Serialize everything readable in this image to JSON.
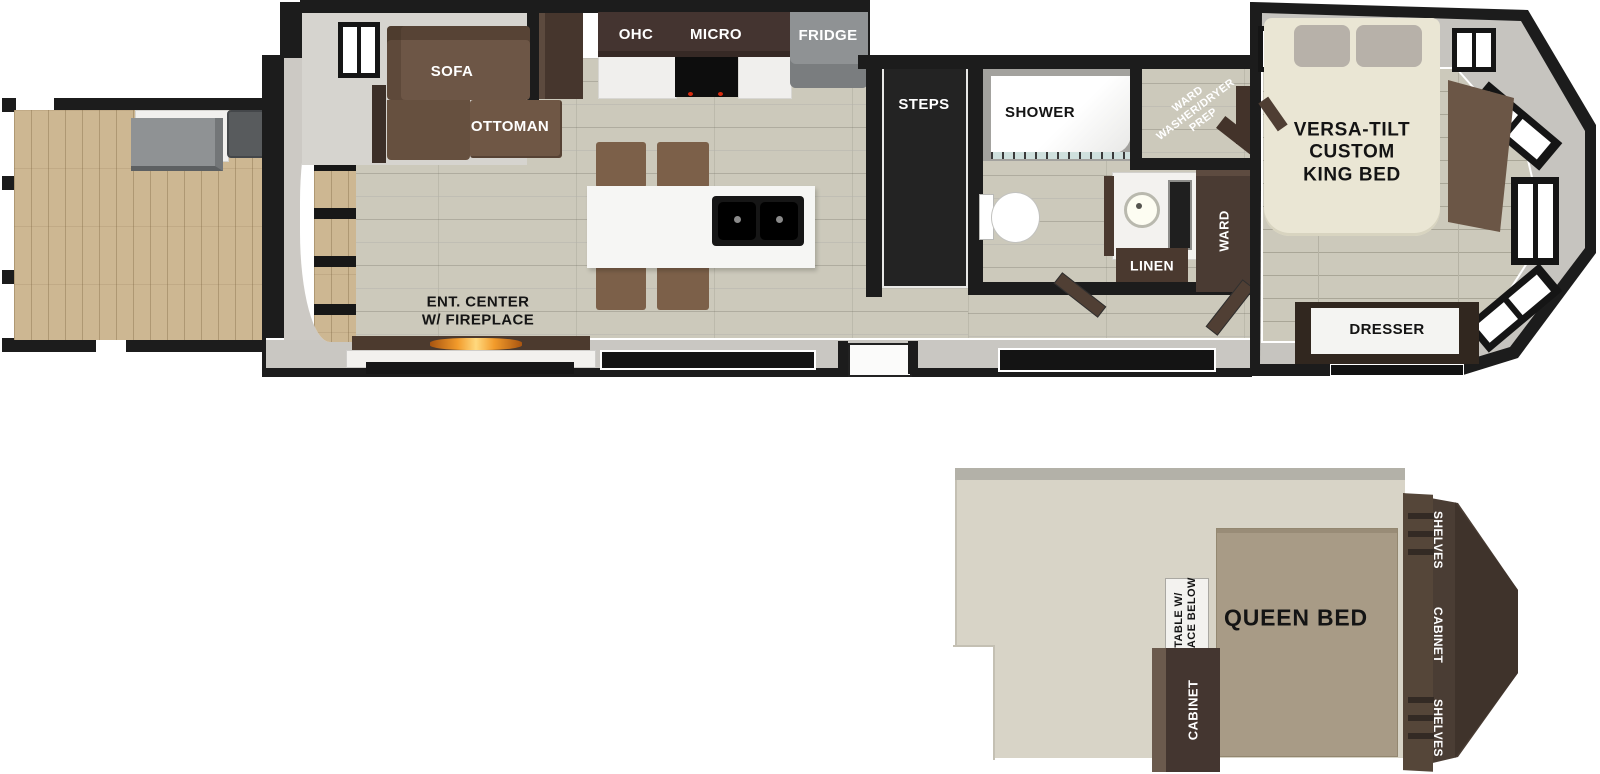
{
  "main_floor": {
    "living": {
      "sofa_label": "SOFA",
      "ottoman_label": "OTTOMAN",
      "ent_center_label": "ENT. CENTER\nW/ FIREPLACE"
    },
    "kitchen": {
      "ohc_label": "OHC",
      "micro_label": "MICRO",
      "fridge_label": "FRIDGE"
    },
    "steps_label": "STEPS",
    "bathroom": {
      "shower_label": "SHOWER",
      "linen_label": "LINEN"
    },
    "storage": {
      "ward_wd_prep_label": "WARD\nWASHER/DRYER\nPREP",
      "ward_label": "WARD"
    },
    "bedroom": {
      "king_bed_label": "VERSA-TILT\nCUSTOM\nKING BED",
      "dresser_label": "DRESSER"
    }
  },
  "loft": {
    "queen_bed_label": "QUEEN BED",
    "table_label": "TABLE W/\nSPACE BELOW",
    "cabinet_label": "CABINET",
    "right_unit": {
      "shelves_top_label": "SHELVES",
      "cabinet_label": "CABINET",
      "shelves_bottom_label": "SHELVES"
    }
  },
  "colors": {
    "wall_black": "#1c1c1c",
    "interior_floor": "#ccc9bb",
    "deck_floor": "#cdb792",
    "furniture_brown": "#6d5646",
    "cabinet_dark_brown": "#46362d",
    "counter_white": "#f2f1ee",
    "appliance_gray": "#8f9294",
    "king_bed_cream": "#eae6d4",
    "queen_bed_taupe": "#a89b86",
    "loft_floor_beige": "#d8d4c7",
    "fireplace_flame_orange": "#f29b2b"
  }
}
